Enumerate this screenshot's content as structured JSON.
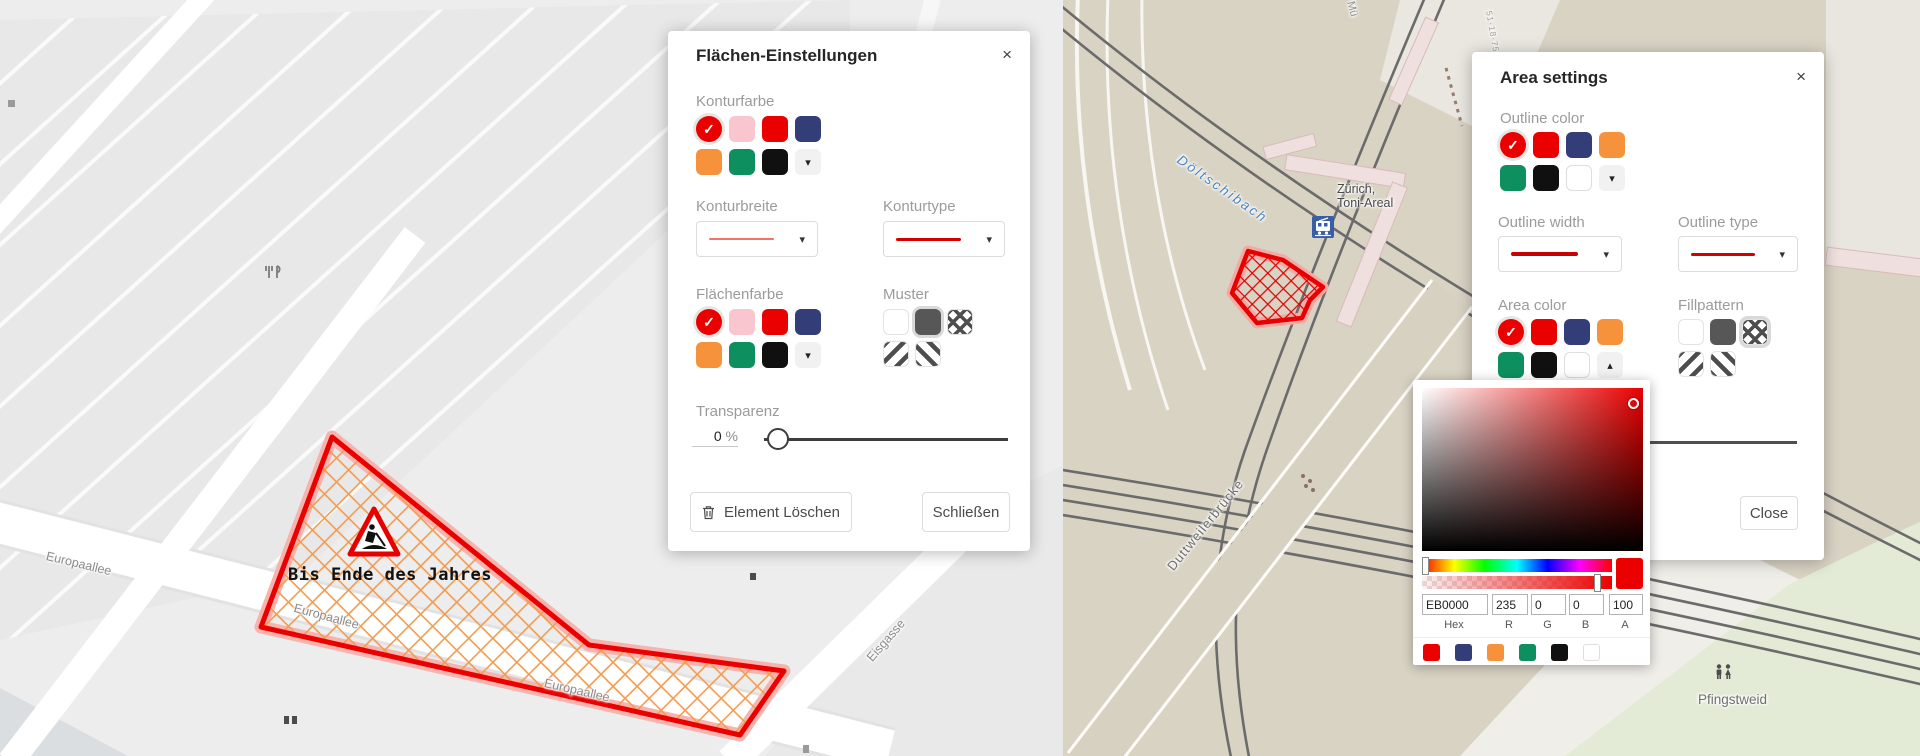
{
  "icons": {
    "check_icon": "✓",
    "arrow_down_icon": "▾",
    "arrow_up_icon": "▴",
    "close_icon": "×"
  },
  "left_dialog": {
    "title": "Flächen-Einstellungen",
    "close_icon": "×",
    "outline_color_label": "Konturfarbe",
    "outline_width_label": "Konturbreite",
    "outline_type_label": "Konturtype",
    "area_color_label": "Flächenfarbe",
    "pattern_label": "Muster",
    "transparency_label": "Transparenz",
    "transparency_value": "0",
    "transparency_unit": "%",
    "delete_button": "Element Löschen",
    "close_button": "Schließen",
    "width_line_style": "background:#f0726b;height:2px",
    "type_line_style": "background:#d40000;height:3px"
  },
  "right_dialog": {
    "title": "Area settings",
    "close_icon": "×",
    "outline_color_label": "Outline color",
    "outline_width_label": "Outline width",
    "outline_type_label": "Outline type",
    "area_color_label": "Area color",
    "pattern_label": "Fillpattern",
    "close_button": "Close",
    "width_line_style": "background:#c70000;height:4px",
    "type_line_style": "background:#d40000;height:3px"
  },
  "color_picker": {
    "hex_value": "EB0000",
    "r_value": "235",
    "g_value": "0",
    "b_value": "0",
    "a_value": "100",
    "hex_label": "Hex",
    "r_label": "R",
    "g_label": "G",
    "b_label": "B",
    "a_label": "A",
    "base_color": "#eb0000"
  },
  "swatch_groups": {
    "de_outline": [
      {
        "c": "#eb0000",
        "sel": true
      },
      {
        "c": "#f9c5ce"
      },
      {
        "c": "#eb0000"
      },
      {
        "c": "#333e78"
      },
      {
        "c": "#f7923c"
      },
      {
        "c": "#0e8f5f"
      },
      {
        "c": "#101010"
      },
      {
        "more": "down"
      }
    ],
    "de_area": [
      {
        "c": "#eb0000",
        "sel": true
      },
      {
        "c": "#f9c5ce"
      },
      {
        "c": "#eb0000"
      },
      {
        "c": "#333e78"
      },
      {
        "c": "#f7923c"
      },
      {
        "c": "#0e8f5f"
      },
      {
        "c": "#101010"
      },
      {
        "more": "down"
      }
    ],
    "en_outline": [
      {
        "c": "#eb0000",
        "sel": true
      },
      {
        "c": "#eb0000"
      },
      {
        "c": "#333e78"
      },
      {
        "c": "#f7923c"
      },
      {
        "c": "#0e8f5f"
      },
      {
        "c": "#101010"
      },
      {
        "c": "#ffffff"
      },
      {
        "more": "down"
      }
    ],
    "en_area": [
      {
        "c": "#eb0000",
        "sel": true
      },
      {
        "c": "#eb0000"
      },
      {
        "c": "#333e78"
      },
      {
        "c": "#f7923c"
      },
      {
        "c": "#0e8f5f"
      },
      {
        "c": "#101010"
      },
      {
        "c": "#ffffff"
      },
      {
        "more": "up"
      }
    ],
    "de_pattern": [
      {
        "p": "none"
      },
      {
        "p": "solid",
        "sel": true
      },
      {
        "p": "cross"
      },
      {
        "p": "d1"
      },
      {
        "p": "d2"
      }
    ],
    "en_pattern": [
      {
        "p": "none"
      },
      {
        "p": "solid"
      },
      {
        "p": "cross",
        "sel": true
      },
      {
        "p": "d1"
      },
      {
        "p": "d2"
      }
    ],
    "picker_presets": [
      {
        "c": "#eb0000"
      },
      {
        "c": "#333e78"
      },
      {
        "c": "#f7923c"
      },
      {
        "c": "#0e8f5f"
      },
      {
        "c": "#101010"
      },
      {
        "c": "#ffffff"
      }
    ]
  },
  "left_map": {
    "streets": [
      "Europaallee",
      "Europaallee",
      "Europaallee",
      "Eisgasse"
    ],
    "annotation": "Bis Ende des Jahres"
  },
  "right_map": {
    "water_label": "Döltschibach",
    "station_line1": "Zürich,",
    "station_line2": "Toni-Areal",
    "bridge_label": "Duttweilerbrücke",
    "area_label": "Pfingstweid",
    "street_partial": "Mü",
    "house_numbers": "51·18·75·5"
  },
  "colors": {
    "accent_red": "#eb0000",
    "halo_pink": "#f7b3ae",
    "hatch_orange": "#f59b4e",
    "pattern_gray": "#575757",
    "map_left_bg": "#ededed",
    "map_right_bg": "#d9d3c4",
    "park_green": "#e3ebd6",
    "building_pink": "#efdfde",
    "rail_gray": "#6b6b6b",
    "water_blue": "#4a84c4",
    "tram_blue": "#3a5da8"
  }
}
